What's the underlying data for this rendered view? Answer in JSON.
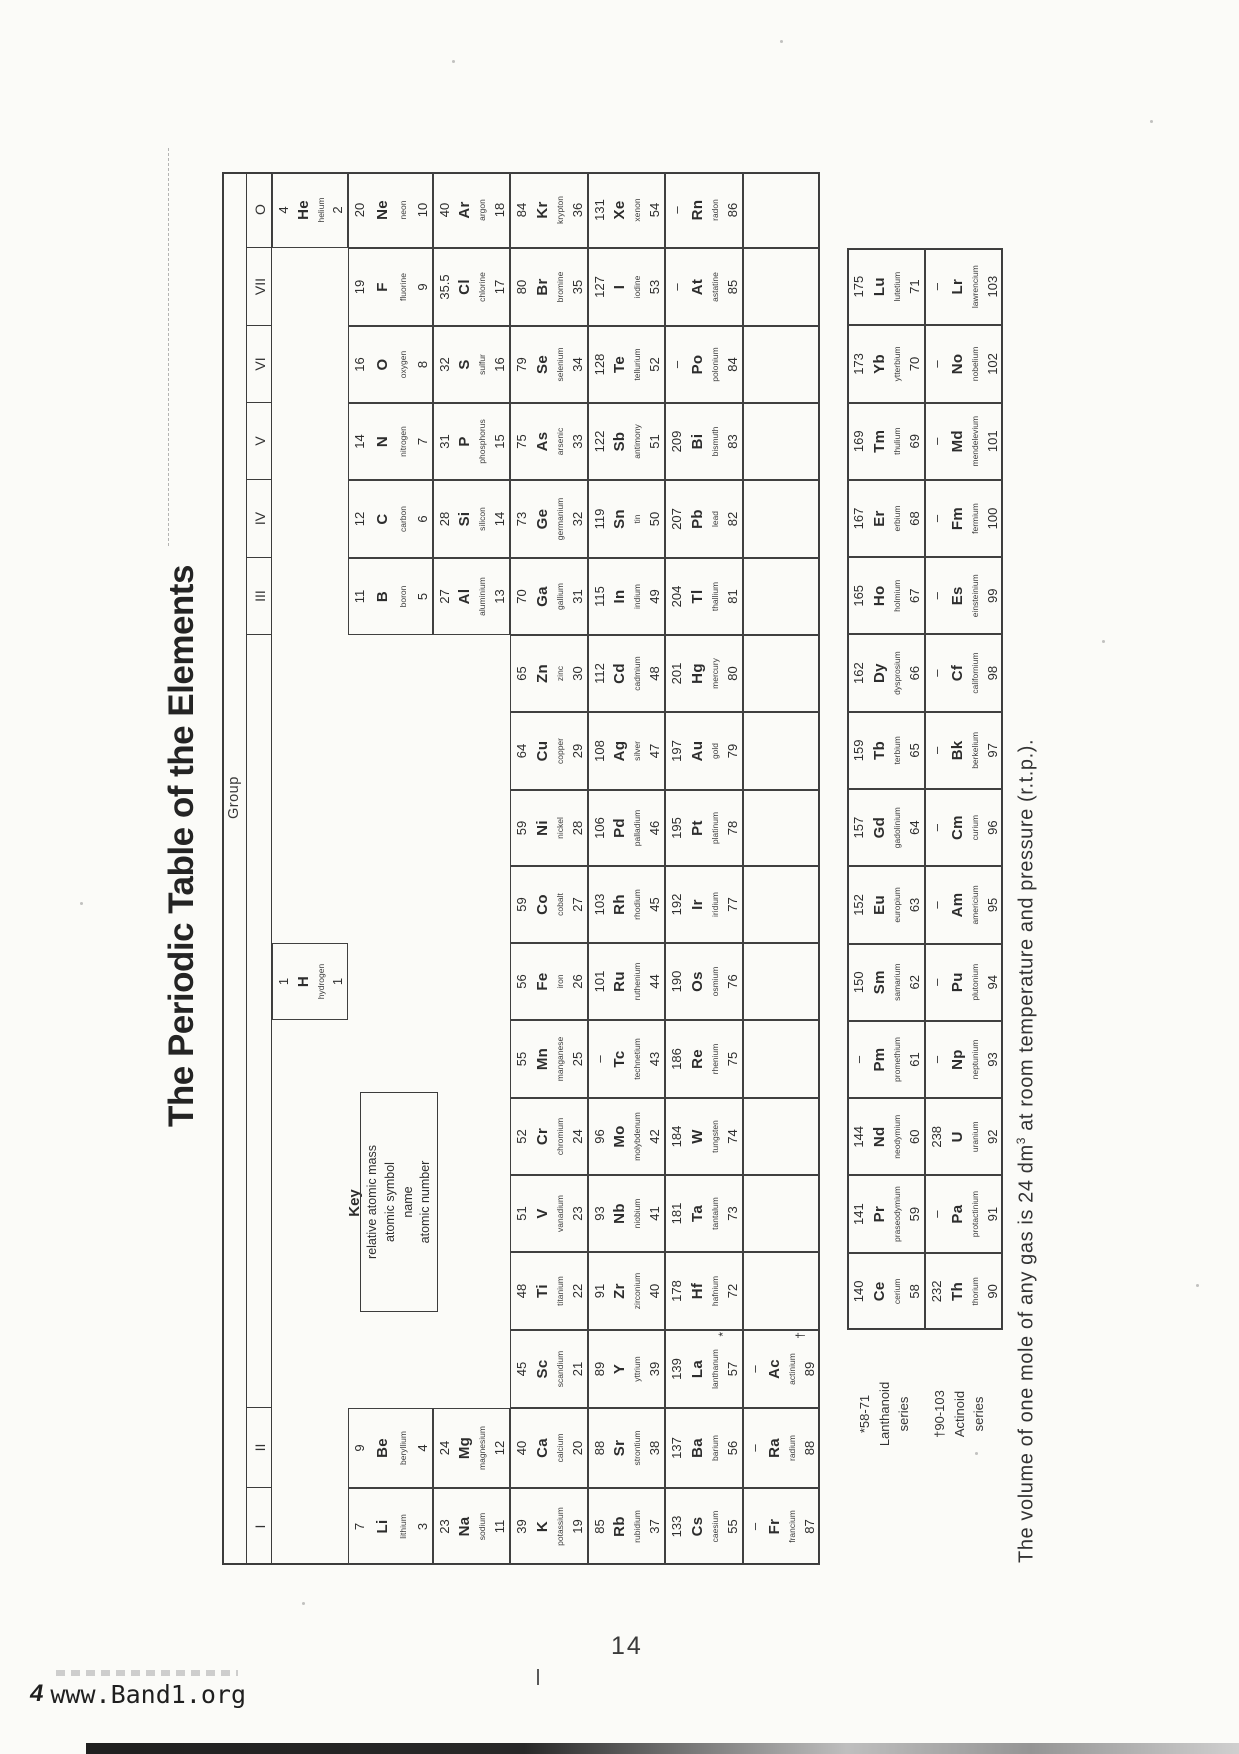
{
  "title": "The Periodic Table of the Elements",
  "group_label": "Group",
  "key": {
    "title": "Key",
    "lines": [
      "relative atomic mass",
      "atomic symbol",
      "name",
      "atomic number"
    ]
  },
  "footnote": {
    "pre": "The volume of one mole of any gas is 24 dm",
    "sup": "3",
    "post": " at room temperature and pressure (r.t.p.)."
  },
  "series_labels": {
    "lanthanoid": [
      "*58-71",
      "Lanthanoid",
      "series"
    ],
    "actinoid": [
      "†90-103",
      "Actinoid",
      "series"
    ]
  },
  "page": {
    "number": "14",
    "footer": {
      "prefix": "4",
      "site": "www.Band1.org"
    }
  },
  "table": {
    "group_headers": [
      "I",
      "II",
      "",
      "III",
      "IV",
      "V",
      "VI",
      "VII",
      "O"
    ],
    "cells": [
      {
        "col": 0,
        "period": "p2",
        "mass": "7",
        "symbol": "Li",
        "name": "lithium",
        "number": "3"
      },
      {
        "col": 0,
        "period": "p3",
        "mass": "23",
        "symbol": "Na",
        "name": "sodium",
        "number": "11"
      },
      {
        "col": 0,
        "period": "p4",
        "mass": "39",
        "symbol": "K",
        "name": "potassium",
        "number": "19"
      },
      {
        "col": 0,
        "period": "p5",
        "mass": "85",
        "symbol": "Rb",
        "name": "rubidium",
        "number": "37"
      },
      {
        "col": 0,
        "period": "p6",
        "mass": "133",
        "symbol": "Cs",
        "name": "caesium",
        "number": "55"
      },
      {
        "col": 0,
        "period": "p7",
        "mass": "–",
        "symbol": "Fr",
        "name": "francium",
        "number": "87"
      },
      {
        "col": 1,
        "period": "p2",
        "mass": "9",
        "symbol": "Be",
        "name": "beryllium",
        "number": "4"
      },
      {
        "col": 1,
        "period": "p3",
        "mass": "24",
        "symbol": "Mg",
        "name": "magnesium",
        "number": "12"
      },
      {
        "col": 1,
        "period": "p4",
        "mass": "40",
        "symbol": "Ca",
        "name": "calcium",
        "number": "20"
      },
      {
        "col": 1,
        "period": "p5",
        "mass": "88",
        "symbol": "Sr",
        "name": "strontium",
        "number": "38"
      },
      {
        "col": 1,
        "period": "p6",
        "mass": "137",
        "symbol": "Ba",
        "name": "barium",
        "number": "56"
      },
      {
        "col": 1,
        "period": "p7",
        "mass": "–",
        "symbol": "Ra",
        "name": "radium",
        "number": "88"
      },
      {
        "col": 2,
        "period": "p4",
        "mass": "45",
        "symbol": "Sc",
        "name": "scandium",
        "number": "21"
      },
      {
        "col": 2,
        "period": "p5",
        "mass": "89",
        "symbol": "Y",
        "name": "yttrium",
        "number": "39"
      },
      {
        "col": 2,
        "period": "p6",
        "mass": "139",
        "symbol": "La",
        "name": "lanthanum",
        "number": "57",
        "marker": "*"
      },
      {
        "col": 2,
        "period": "p7",
        "mass": "–",
        "symbol": "Ac",
        "name": "actinium",
        "number": "89",
        "marker": "†"
      },
      {
        "col": 3,
        "period": "p4",
        "mass": "48",
        "symbol": "Ti",
        "name": "titanium",
        "number": "22"
      },
      {
        "col": 3,
        "period": "p5",
        "mass": "91",
        "symbol": "Zr",
        "name": "zirconium",
        "number": "40"
      },
      {
        "col": 3,
        "period": "p6",
        "mass": "178",
        "symbol": "Hf",
        "name": "hafnium",
        "number": "72"
      },
      {
        "col": 4,
        "period": "p4",
        "mass": "51",
        "symbol": "V",
        "name": "vanadium",
        "number": "23"
      },
      {
        "col": 4,
        "period": "p5",
        "mass": "93",
        "symbol": "Nb",
        "name": "niobium",
        "number": "41"
      },
      {
        "col": 4,
        "period": "p6",
        "mass": "181",
        "symbol": "Ta",
        "name": "tantalum",
        "number": "73"
      },
      {
        "col": 5,
        "period": "p4",
        "mass": "52",
        "symbol": "Cr",
        "name": "chromium",
        "number": "24"
      },
      {
        "col": 5,
        "period": "p5",
        "mass": "96",
        "symbol": "Mo",
        "name": "molybdenum",
        "number": "42"
      },
      {
        "col": 5,
        "period": "p6",
        "mass": "184",
        "symbol": "W",
        "name": "tungsten",
        "number": "74"
      },
      {
        "col": 6,
        "period": "p4",
        "mass": "55",
        "symbol": "Mn",
        "name": "manganese",
        "number": "25"
      },
      {
        "col": 6,
        "period": "p5",
        "mass": "–",
        "symbol": "Tc",
        "name": "technetium",
        "number": "43"
      },
      {
        "col": 6,
        "period": "p6",
        "mass": "186",
        "symbol": "Re",
        "name": "rhenium",
        "number": "75"
      },
      {
        "col": 7,
        "period": "p1",
        "mass": "1",
        "symbol": "H",
        "name": "hydrogen",
        "number": "1"
      },
      {
        "col": 7,
        "period": "p4",
        "mass": "56",
        "symbol": "Fe",
        "name": "iron",
        "number": "26"
      },
      {
        "col": 7,
        "period": "p5",
        "mass": "101",
        "symbol": "Ru",
        "name": "ruthenium",
        "number": "44"
      },
      {
        "col": 7,
        "period": "p6",
        "mass": "190",
        "symbol": "Os",
        "name": "osmium",
        "number": "76"
      },
      {
        "col": 8,
        "period": "p4",
        "mass": "59",
        "symbol": "Co",
        "name": "cobalt",
        "number": "27"
      },
      {
        "col": 8,
        "period": "p5",
        "mass": "103",
        "symbol": "Rh",
        "name": "rhodium",
        "number": "45"
      },
      {
        "col": 8,
        "period": "p6",
        "mass": "192",
        "symbol": "Ir",
        "name": "iridium",
        "number": "77"
      },
      {
        "col": 9,
        "period": "p4",
        "mass": "59",
        "symbol": "Ni",
        "name": "nickel",
        "number": "28"
      },
      {
        "col": 9,
        "period": "p5",
        "mass": "106",
        "symbol": "Pd",
        "name": "palladium",
        "number": "46"
      },
      {
        "col": 9,
        "period": "p6",
        "mass": "195",
        "symbol": "Pt",
        "name": "platinum",
        "number": "78"
      },
      {
        "col": 10,
        "period": "p4",
        "mass": "64",
        "symbol": "Cu",
        "name": "copper",
        "number": "29"
      },
      {
        "col": 10,
        "period": "p5",
        "mass": "108",
        "symbol": "Ag",
        "name": "silver",
        "number": "47"
      },
      {
        "col": 10,
        "period": "p6",
        "mass": "197",
        "symbol": "Au",
        "name": "gold",
        "number": "79"
      },
      {
        "col": 11,
        "period": "p4",
        "mass": "65",
        "symbol": "Zn",
        "name": "zinc",
        "number": "30"
      },
      {
        "col": 11,
        "period": "p5",
        "mass": "112",
        "symbol": "Cd",
        "name": "cadmium",
        "number": "48"
      },
      {
        "col": 11,
        "period": "p6",
        "mass": "201",
        "symbol": "Hg",
        "name": "mercury",
        "number": "80"
      },
      {
        "col": 12,
        "period": "p2",
        "mass": "11",
        "symbol": "B",
        "name": "boron",
        "number": "5"
      },
      {
        "col": 12,
        "period": "p3",
        "mass": "27",
        "symbol": "Al",
        "name": "aluminium",
        "number": "13"
      },
      {
        "col": 12,
        "period": "p4",
        "mass": "70",
        "symbol": "Ga",
        "name": "gallium",
        "number": "31"
      },
      {
        "col": 12,
        "period": "p5",
        "mass": "115",
        "symbol": "In",
        "name": "indium",
        "number": "49"
      },
      {
        "col": 12,
        "period": "p6",
        "mass": "204",
        "symbol": "Tl",
        "name": "thallium",
        "number": "81"
      },
      {
        "col": 13,
        "period": "p2",
        "mass": "12",
        "symbol": "C",
        "name": "carbon",
        "number": "6"
      },
      {
        "col": 13,
        "period": "p3",
        "mass": "28",
        "symbol": "Si",
        "name": "silicon",
        "number": "14"
      },
      {
        "col": 13,
        "period": "p4",
        "mass": "73",
        "symbol": "Ge",
        "name": "germanium",
        "number": "32"
      },
      {
        "col": 13,
        "period": "p5",
        "mass": "119",
        "symbol": "Sn",
        "name": "tin",
        "number": "50"
      },
      {
        "col": 13,
        "period": "p6",
        "mass": "207",
        "symbol": "Pb",
        "name": "lead",
        "number": "82"
      },
      {
        "col": 14,
        "period": "p2",
        "mass": "14",
        "symbol": "N",
        "name": "nitrogen",
        "number": "7"
      },
      {
        "col": 14,
        "period": "p3",
        "mass": "31",
        "symbol": "P",
        "name": "phosphorus",
        "number": "15"
      },
      {
        "col": 14,
        "period": "p4",
        "mass": "75",
        "symbol": "As",
        "name": "arsenic",
        "number": "33"
      },
      {
        "col": 14,
        "period": "p5",
        "mass": "122",
        "symbol": "Sb",
        "name": "antimony",
        "number": "51"
      },
      {
        "col": 14,
        "period": "p6",
        "mass": "209",
        "symbol": "Bi",
        "name": "bismuth",
        "number": "83"
      },
      {
        "col": 15,
        "period": "p2",
        "mass": "16",
        "symbol": "O",
        "name": "oxygen",
        "number": "8"
      },
      {
        "col": 15,
        "period": "p3",
        "mass": "32",
        "symbol": "S",
        "name": "sulfur",
        "number": "16"
      },
      {
        "col": 15,
        "period": "p4",
        "mass": "79",
        "symbol": "Se",
        "name": "selenium",
        "number": "34"
      },
      {
        "col": 15,
        "period": "p5",
        "mass": "128",
        "symbol": "Te",
        "name": "tellurium",
        "number": "52"
      },
      {
        "col": 15,
        "period": "p6",
        "mass": "–",
        "symbol": "Po",
        "name": "polonium",
        "number": "84"
      },
      {
        "col": 16,
        "period": "p2",
        "mass": "19",
        "symbol": "F",
        "name": "fluorine",
        "number": "9"
      },
      {
        "col": 16,
        "period": "p3",
        "mass": "35.5",
        "symbol": "Cl",
        "name": "chlorine",
        "number": "17"
      },
      {
        "col": 16,
        "period": "p4",
        "mass": "80",
        "symbol": "Br",
        "name": "bromine",
        "number": "35"
      },
      {
        "col": 16,
        "period": "p5",
        "mass": "127",
        "symbol": "I",
        "name": "iodine",
        "number": "53"
      },
      {
        "col": 16,
        "period": "p6",
        "mass": "–",
        "symbol": "At",
        "name": "astatine",
        "number": "85"
      },
      {
        "col": 17,
        "period": "p1",
        "mass": "4",
        "symbol": "He",
        "name": "helium",
        "number": "2"
      },
      {
        "col": 17,
        "period": "p2",
        "mass": "20",
        "symbol": "Ne",
        "name": "neon",
        "number": "10"
      },
      {
        "col": 17,
        "period": "p3",
        "mass": "40",
        "symbol": "Ar",
        "name": "argon",
        "number": "18"
      },
      {
        "col": 17,
        "period": "p4",
        "mass": "84",
        "symbol": "Kr",
        "name": "krypton",
        "number": "36"
      },
      {
        "col": 17,
        "period": "p5",
        "mass": "131",
        "symbol": "Xe",
        "name": "xenon",
        "number": "54"
      },
      {
        "col": 17,
        "period": "p6",
        "mass": "–",
        "symbol": "Rn",
        "name": "radon",
        "number": "86"
      }
    ],
    "empty_cells": [
      {
        "col": 3,
        "period": "p7"
      },
      {
        "col": 4,
        "period": "p7"
      },
      {
        "col": 5,
        "period": "p7"
      },
      {
        "col": 6,
        "period": "p7"
      },
      {
        "col": 7,
        "period": "p7"
      },
      {
        "col": 8,
        "period": "p7"
      },
      {
        "col": 9,
        "period": "p7"
      },
      {
        "col": 10,
        "period": "p7"
      },
      {
        "col": 11,
        "period": "p7"
      },
      {
        "col": 12,
        "period": "p7"
      },
      {
        "col": 13,
        "period": "p7"
      },
      {
        "col": 14,
        "period": "p7"
      },
      {
        "col": 15,
        "period": "p7"
      },
      {
        "col": 16,
        "period": "p7"
      },
      {
        "col": 17,
        "period": "p7"
      }
    ],
    "lanthanoids": [
      {
        "mass": "140",
        "symbol": "Ce",
        "name": "cerium",
        "number": "58"
      },
      {
        "mass": "141",
        "symbol": "Pr",
        "name": "praseodymium",
        "number": "59"
      },
      {
        "mass": "144",
        "symbol": "Nd",
        "name": "neodymium",
        "number": "60"
      },
      {
        "mass": "–",
        "symbol": "Pm",
        "name": "promethium",
        "number": "61"
      },
      {
        "mass": "150",
        "symbol": "Sm",
        "name": "samarium",
        "number": "62"
      },
      {
        "mass": "152",
        "symbol": "Eu",
        "name": "europium",
        "number": "63"
      },
      {
        "mass": "157",
        "symbol": "Gd",
        "name": "gadolinium",
        "number": "64"
      },
      {
        "mass": "159",
        "symbol": "Tb",
        "name": "terbium",
        "number": "65"
      },
      {
        "mass": "162",
        "symbol": "Dy",
        "name": "dysprosium",
        "number": "66"
      },
      {
        "mass": "165",
        "symbol": "Ho",
        "name": "holmium",
        "number": "67"
      },
      {
        "mass": "167",
        "symbol": "Er",
        "name": "erbium",
        "number": "68"
      },
      {
        "mass": "169",
        "symbol": "Tm",
        "name": "thulium",
        "number": "69"
      },
      {
        "mass": "173",
        "symbol": "Yb",
        "name": "ytterbium",
        "number": "70"
      },
      {
        "mass": "175",
        "symbol": "Lu",
        "name": "lutetium",
        "number": "71"
      }
    ],
    "actinoids": [
      {
        "mass": "232",
        "symbol": "Th",
        "name": "thorium",
        "number": "90"
      },
      {
        "mass": "–",
        "symbol": "Pa",
        "name": "protactinium",
        "number": "91"
      },
      {
        "mass": "238",
        "symbol": "U",
        "name": "uranium",
        "number": "92"
      },
      {
        "mass": "–",
        "symbol": "Np",
        "name": "neptunium",
        "number": "93"
      },
      {
        "mass": "–",
        "symbol": "Pu",
        "name": "plutonium",
        "number": "94"
      },
      {
        "mass": "–",
        "symbol": "Am",
        "name": "americium",
        "number": "95"
      },
      {
        "mass": "–",
        "symbol": "Cm",
        "name": "curium",
        "number": "96"
      },
      {
        "mass": "–",
        "symbol": "Bk",
        "name": "berkelium",
        "number": "97"
      },
      {
        "mass": "–",
        "symbol": "Cf",
        "name": "californium",
        "number": "98"
      },
      {
        "mass": "–",
        "symbol": "Es",
        "name": "einsteinium",
        "number": "99"
      },
      {
        "mass": "–",
        "symbol": "Fm",
        "name": "fermium",
        "number": "100"
      },
      {
        "mass": "–",
        "symbol": "Md",
        "name": "mendelevium",
        "number": "101"
      },
      {
        "mass": "–",
        "symbol": "No",
        "name": "nobelium",
        "number": "102"
      },
      {
        "mass": "–",
        "symbol": "Lr",
        "name": "lawrencium",
        "number": "103"
      }
    ]
  }
}
